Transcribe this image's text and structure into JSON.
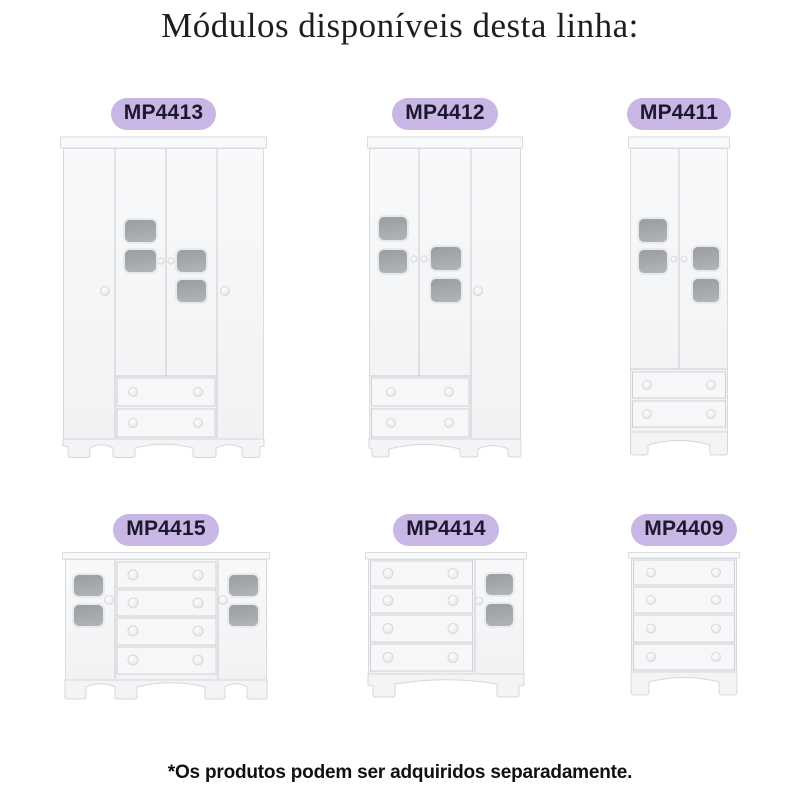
{
  "page": {
    "title": "Módulos disponíveis desta linha:",
    "footnote": "*Os produtos podem ser adquiridos separadamente.",
    "background_color": "#ffffff",
    "title_color": "#1e1e1e",
    "footnote_color": "#101010"
  },
  "badge": {
    "bg_color": "#c8b6e4",
    "text_color": "#1b1830"
  },
  "furniture_palette": {
    "body": "#f5f6f7",
    "outline": "#d9dbde",
    "divider": "#c9cbce",
    "window_glass": "#9fa3a6",
    "knob": "#eef0f2"
  },
  "modules": [
    {
      "code": "MP4413",
      "illustration": "wardrobe-4-doors-2-drawers"
    },
    {
      "code": "MP4412",
      "illustration": "wardrobe-3-doors-2-drawers"
    },
    {
      "code": "MP4411",
      "illustration": "wardrobe-2-doors-2-drawers"
    },
    {
      "code": "MP4415",
      "illustration": "dresser-2-doors-4-drawers"
    },
    {
      "code": "MP4414",
      "illustration": "dresser-1-door-4-drawers"
    },
    {
      "code": "MP4409",
      "illustration": "chest-4-drawers"
    }
  ]
}
